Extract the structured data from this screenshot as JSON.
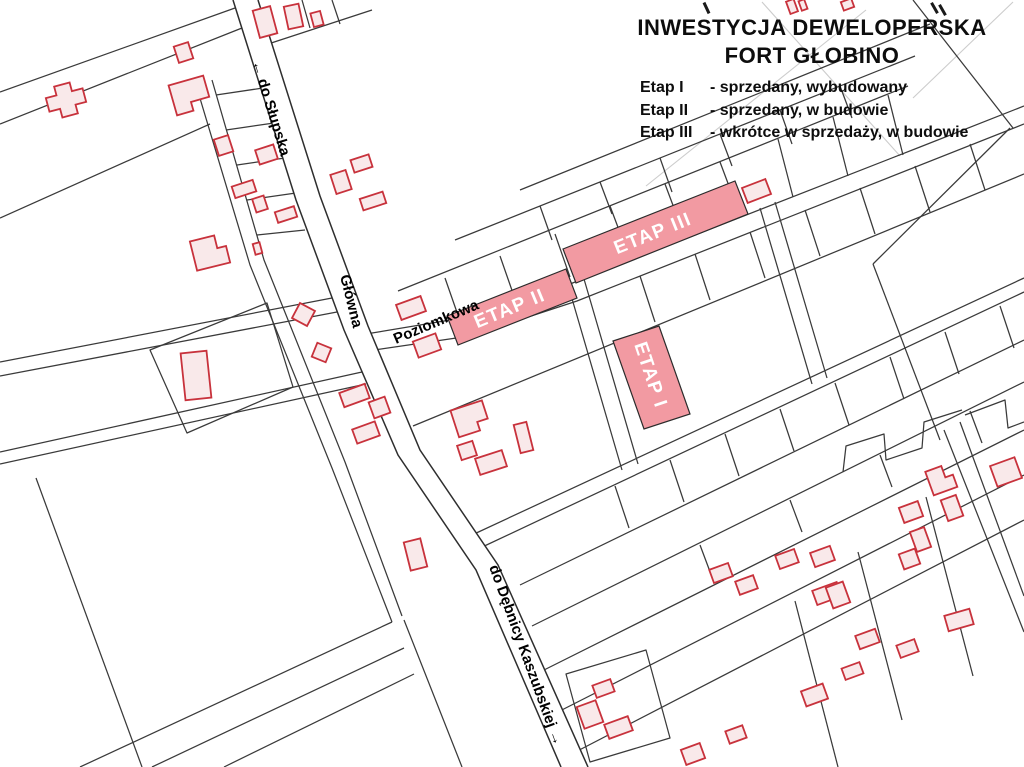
{
  "header": {
    "title_line1": "INWESTYCJA DEWELOPERSKA",
    "title_line2": "FORT GŁOBINO",
    "legend": [
      {
        "label": "Etap I",
        "desc": "- sprzedany, wybudowany"
      },
      {
        "label": "Etap II",
        "desc": "- sprzedany, w budowie"
      },
      {
        "label": "Etap III",
        "desc": "- wkrótce w sprzedaży, w budowie"
      }
    ]
  },
  "map": {
    "streets": {
      "slupska": "← do Słupska",
      "glowna": "Główna",
      "poziomkowa": "Poziomkowa",
      "debnicy": "do Dębnicy Kaszubskiej →"
    },
    "stages": {
      "etap1": "ETAP I",
      "etap2": "ETAP II",
      "etap3": "ETAP III"
    },
    "colors": {
      "stage_fill": "#f29aa2",
      "building_stroke": "#c8323c",
      "building_fill": "#f9e9ea",
      "parcel_line": "#3a3a3a",
      "label_on_stage": "#ffffff"
    }
  }
}
